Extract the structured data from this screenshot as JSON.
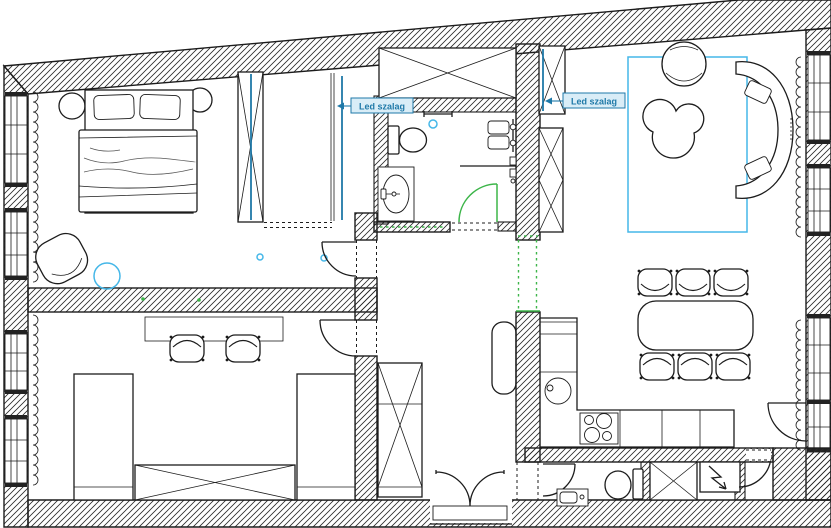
{
  "labels": {
    "led_strip_left": "Led szalag",
    "led_strip_right": "Led szalag"
  },
  "colors": {
    "ink": "#1c1c1c",
    "hatch": "#2a2a2a",
    "led": "#1f79a8",
    "led-label-bg": "#d9edf7",
    "cyan": "#45b7e8",
    "green": "#3cb549",
    "paper": "#ffffff",
    "soft": "#555555"
  }
}
